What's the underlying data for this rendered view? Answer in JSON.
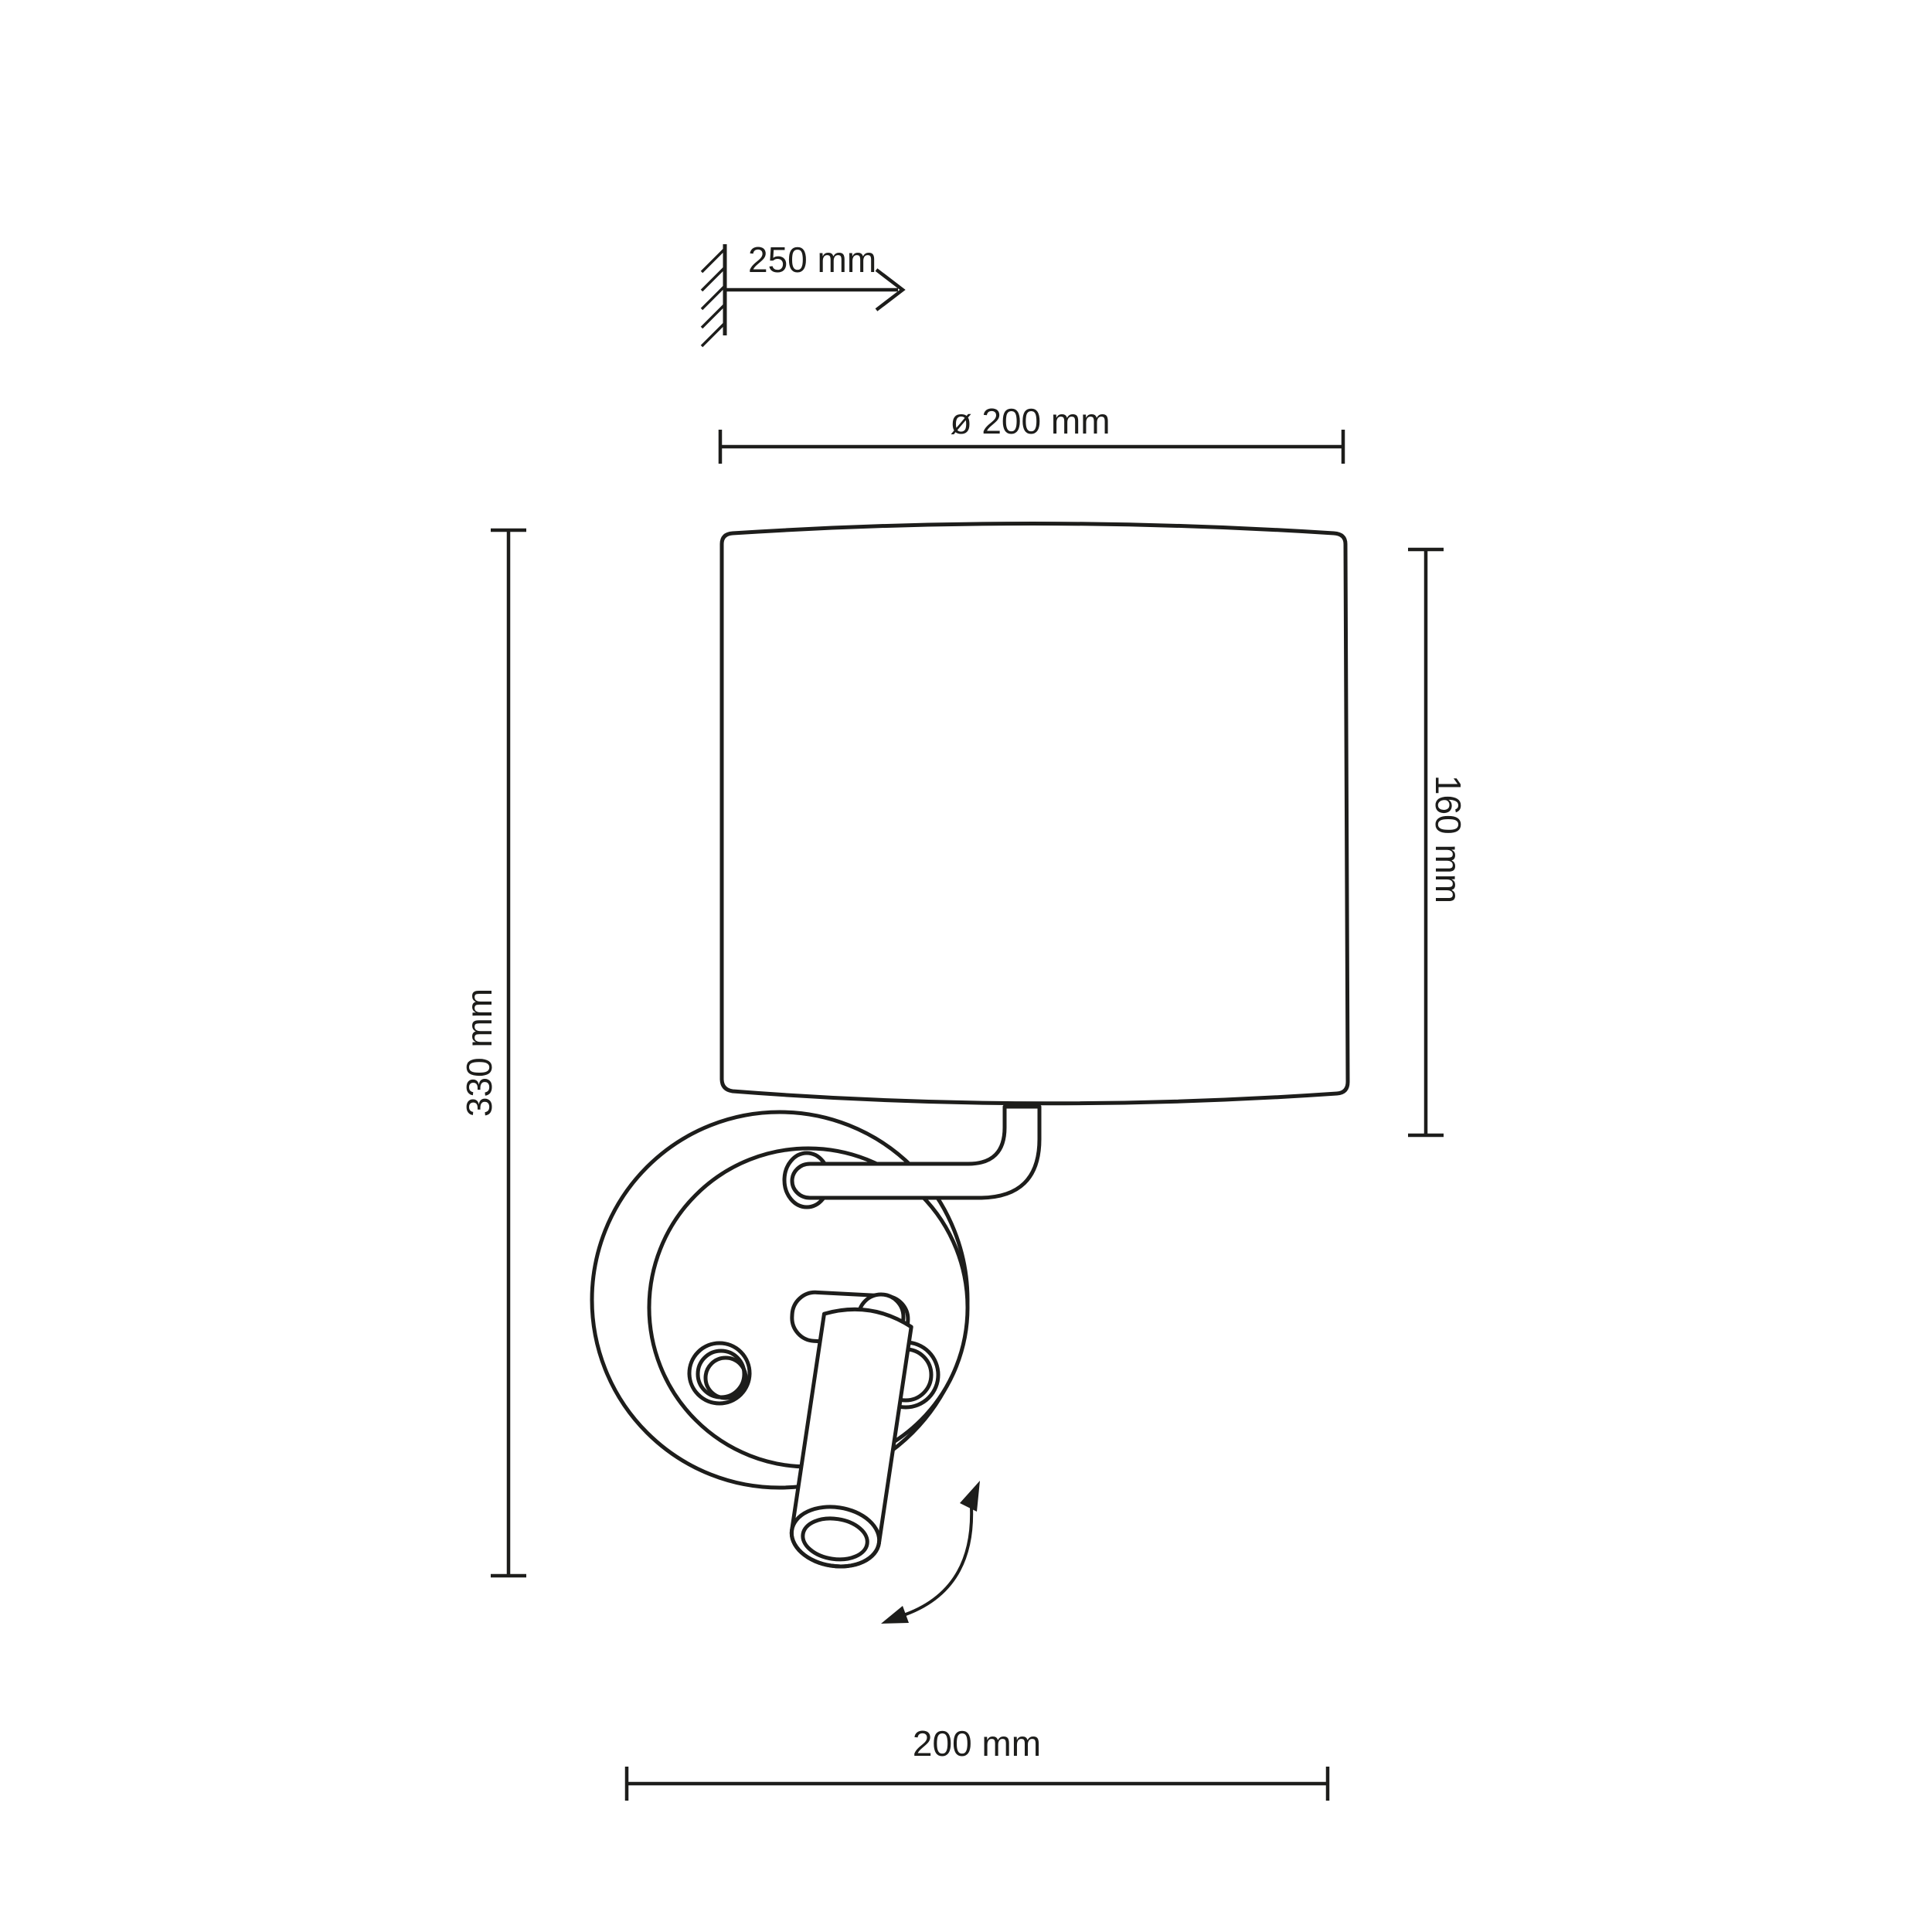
{
  "drawing": {
    "type": "technical dimension drawing",
    "subject": "wall lamp with cylindrical shade and adjustable reading spotlight"
  },
  "colors": {
    "line": "#1d1d1b",
    "background": "#ffffff"
  },
  "dimensions": {
    "wall_projection": "250 mm",
    "shade_diameter": "ø 200 mm",
    "shade_height": "160 mm",
    "total_height": "330 mm",
    "depth": "200 mm"
  }
}
